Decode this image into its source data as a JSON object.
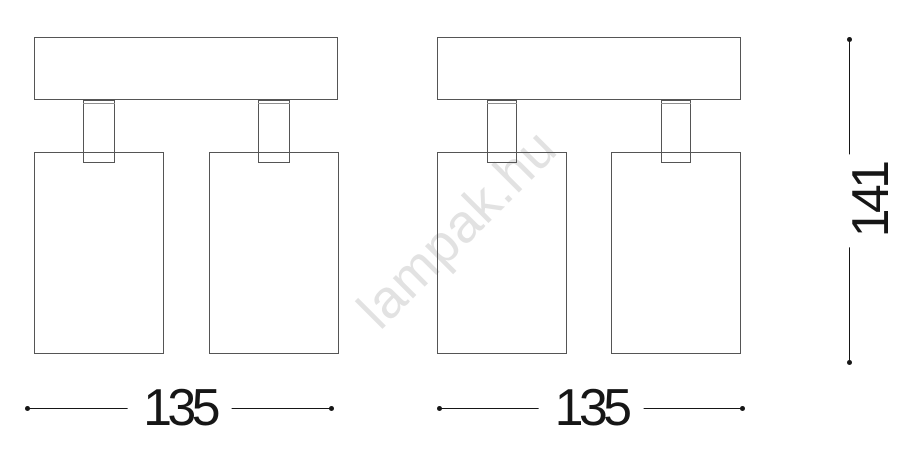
{
  "watermark": {
    "text": "lampak.hu"
  },
  "colors": {
    "outline": "#555555",
    "outline_soft": "#909090",
    "dimension": "#161616",
    "watermark": "#e2e2e2",
    "page_bg": "#ffffff"
  },
  "dimensions": {
    "width_left": {
      "value": "135",
      "unit_shown": "",
      "orientation": "horizontal"
    },
    "width_right": {
      "value": "135",
      "unit_shown": "",
      "orientation": "horizontal"
    },
    "height": {
      "value": "141",
      "unit_shown": "",
      "orientation": "vertical"
    }
  }
}
